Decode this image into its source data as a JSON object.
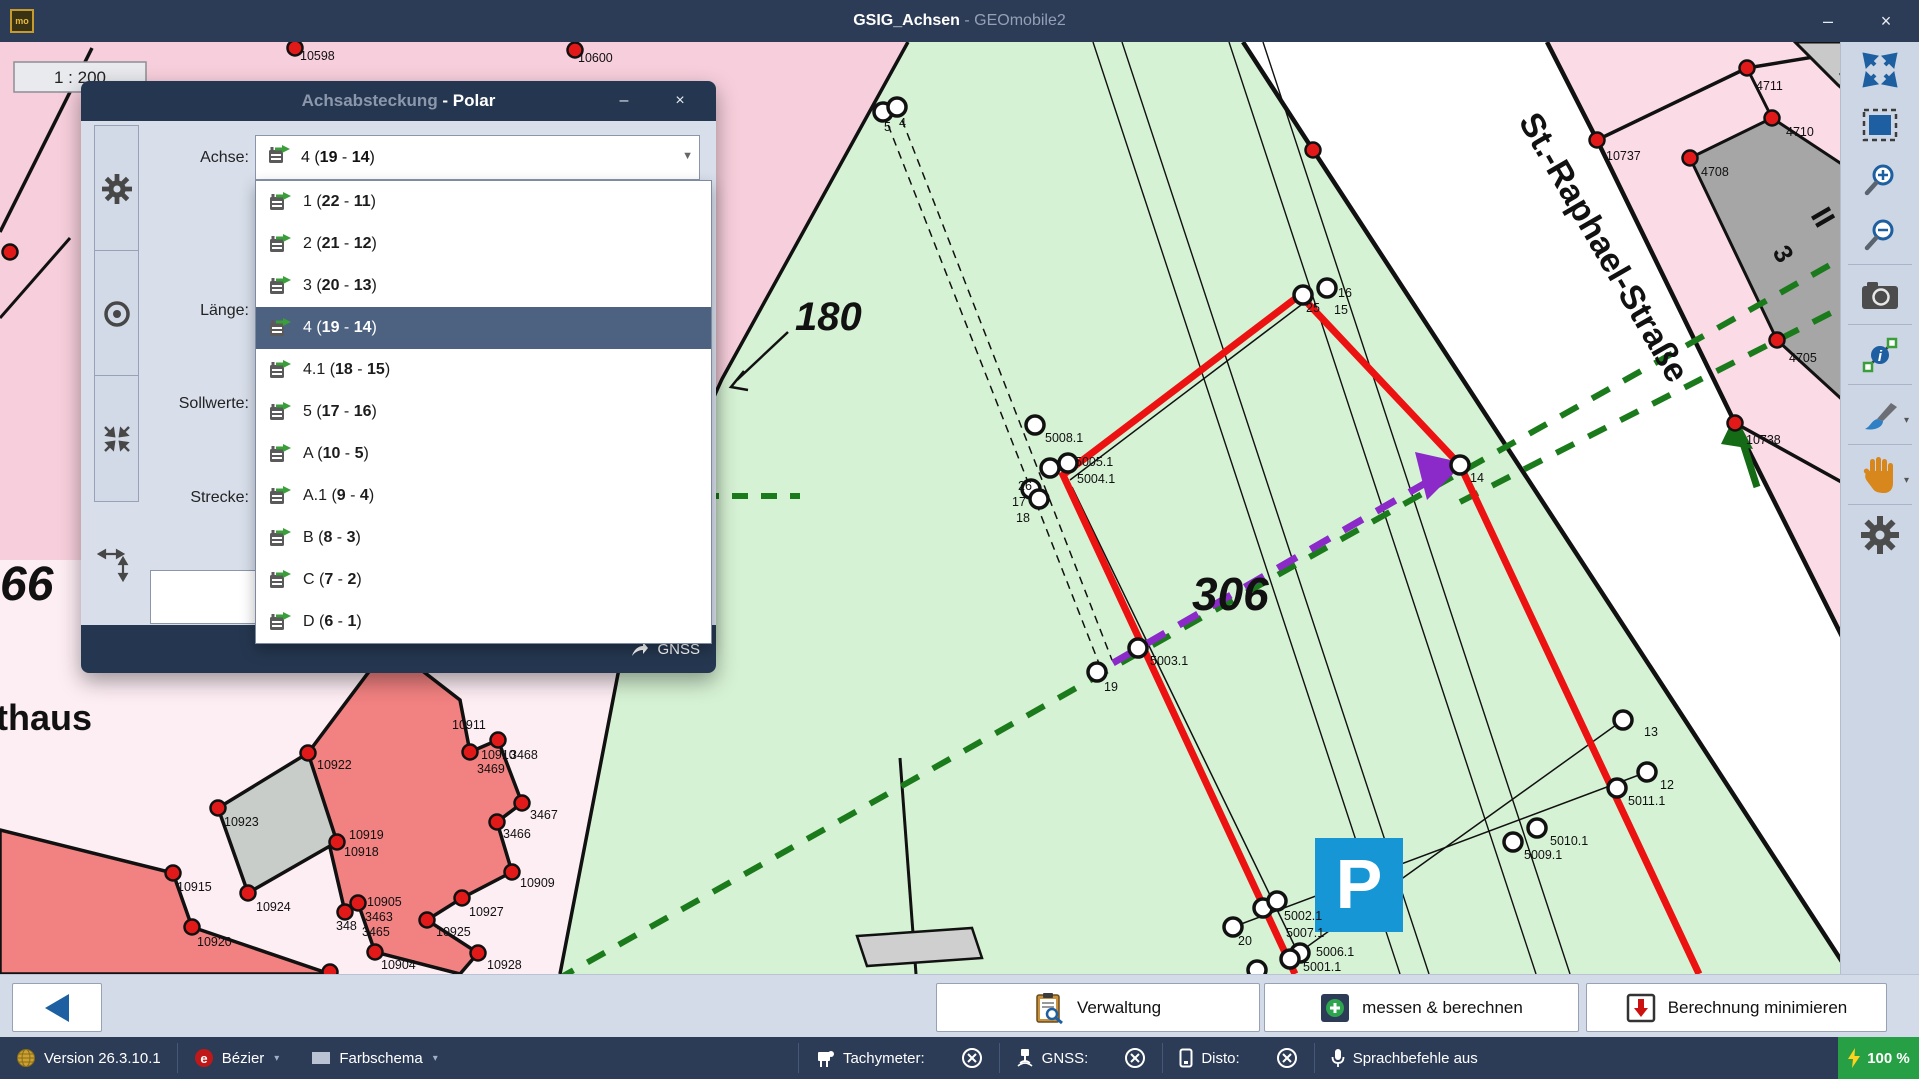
{
  "window": {
    "project": "GSIG_Achsen",
    "app": " - GEOmobile2",
    "badge": "mo",
    "minimize": "–",
    "close": "×"
  },
  "dialog": {
    "title_main": "Achsabsteckung",
    "title_mode": " - Polar",
    "minimize": "–",
    "close": "×",
    "labels": {
      "achse": "Achse:",
      "laenge": "Länge:",
      "sollwerte": "Sollwerte:",
      "strecke": "Strecke:"
    },
    "combo": {
      "name": "4",
      "from": "19",
      "to": "14"
    },
    "gnss_label": "GNSS",
    "dropdown": {
      "selected_index": 3,
      "items": [
        {
          "name": "1",
          "from": "22",
          "to": "11"
        },
        {
          "name": "2",
          "from": "21",
          "to": "12"
        },
        {
          "name": "3",
          "from": "20",
          "to": "13"
        },
        {
          "name": "4",
          "from": "19",
          "to": "14"
        },
        {
          "name": "4.1",
          "from": "18",
          "to": "15"
        },
        {
          "name": "5",
          "from": "17",
          "to": "16"
        },
        {
          "name": "A",
          "from": "10",
          "to": "5"
        },
        {
          "name": "A.1",
          "from": "9",
          "to": "4"
        },
        {
          "name": "B",
          "from": "8",
          "to": "3"
        },
        {
          "name": "C",
          "from": "7",
          "to": "2"
        },
        {
          "name": "D",
          "from": "6",
          "to": "1"
        }
      ]
    }
  },
  "bottom_bar": {
    "verwaltung": "Verwaltung",
    "messen": "messen & berechnen",
    "berechnung": "Berechnung minimieren"
  },
  "status_bar": {
    "version": "Version 26.3.10.1",
    "bezier": "Bézier",
    "farbschema": "Farbschema",
    "tachymeter": "Tachymeter:",
    "gnss": "GNSS:",
    "disto": "Disto:",
    "sprachbefehle": "Sprachbefehle aus",
    "battery": "100 %"
  },
  "map": {
    "scale": "1 : 200",
    "street_label": "St.-Raphael-Straße",
    "parking_label": "P",
    "big": {
      "n180": "180",
      "n306": "306",
      "n66": "66",
      "thaus": "thaus"
    },
    "building_marks": {
      "i": "I",
      "ii": "II",
      "three": "3"
    },
    "colors": {
      "green": "#d6f2d4",
      "pink": "#f7cfdc",
      "pink_light": "#fdeef4",
      "pink_right": "#fadbe6",
      "red_line": "#ec1212",
      "purple": "#8b2ac8",
      "green_dash": "#1b7a1b",
      "salmon": "#f28181",
      "gray_building": "#a6a6a6",
      "parking_blue": "#1796d5"
    },
    "white_points": [
      [
        883,
        112
      ],
      [
        897,
        107
      ],
      [
        1035,
        425
      ],
      [
        1050,
        468
      ],
      [
        1068,
        463
      ],
      [
        1031,
        489
      ],
      [
        1039,
        499
      ],
      [
        1303,
        295
      ],
      [
        1327,
        288
      ],
      [
        1460,
        465
      ],
      [
        1097,
        672
      ],
      [
        1138,
        648
      ],
      [
        1233,
        927
      ],
      [
        1263,
        908
      ],
      [
        1277,
        901
      ],
      [
        1300,
        953
      ],
      [
        1290,
        959
      ],
      [
        1257,
        970
      ],
      [
        1513,
        842
      ],
      [
        1537,
        828
      ],
      [
        1617,
        788
      ],
      [
        1647,
        772
      ],
      [
        1623,
        720
      ]
    ],
    "red_points": [
      [
        1597,
        140
      ],
      [
        1735,
        423
      ],
      [
        1747,
        68
      ],
      [
        1772,
        118
      ],
      [
        1690,
        158
      ],
      [
        1777,
        340
      ],
      [
        1313,
        150
      ],
      [
        308,
        753
      ],
      [
        218,
        808
      ],
      [
        248,
        893
      ],
      [
        337,
        842
      ],
      [
        173,
        873
      ],
      [
        192,
        927
      ],
      [
        470,
        752
      ],
      [
        498,
        740
      ],
      [
        522,
        803
      ],
      [
        497,
        822
      ],
      [
        512,
        872
      ],
      [
        462,
        898
      ],
      [
        427,
        920
      ],
      [
        478,
        953
      ],
      [
        375,
        952
      ],
      [
        358,
        903
      ],
      [
        345,
        912
      ],
      [
        389,
        645
      ],
      [
        295,
        48
      ],
      [
        575,
        50
      ],
      [
        10,
        252
      ],
      [
        330,
        972
      ]
    ],
    "labels": [
      {
        "t": "10598",
        "x": 300,
        "y": 60
      },
      {
        "t": "10600",
        "x": 578,
        "y": 62
      },
      {
        "t": "5",
        "x": 884,
        "y": 131
      },
      {
        "t": "4",
        "x": 899,
        "y": 127
      },
      {
        "t": "5008.1",
        "x": 1045,
        "y": 442
      },
      {
        "t": "5005.1",
        "x": 1075,
        "y": 466
      },
      {
        "t": "5004.1",
        "x": 1077,
        "y": 483
      },
      {
        "t": "26",
        "x": 1018,
        "y": 490
      },
      {
        "t": "17",
        "x": 1012,
        "y": 506
      },
      {
        "t": "18",
        "x": 1016,
        "y": 522
      },
      {
        "t": "16",
        "x": 1338,
        "y": 297
      },
      {
        "t": "25",
        "x": 1306,
        "y": 312
      },
      {
        "t": "15",
        "x": 1334,
        "y": 314
      },
      {
        "t": "14",
        "x": 1470,
        "y": 482
      },
      {
        "t": "19",
        "x": 1104,
        "y": 691
      },
      {
        "t": "5003.1",
        "x": 1150,
        "y": 665
      },
      {
        "t": "20",
        "x": 1238,
        "y": 945
      },
      {
        "t": "5002.1",
        "x": 1284,
        "y": 920
      },
      {
        "t": "5007.1",
        "x": 1286,
        "y": 937
      },
      {
        "t": "5006.1",
        "x": 1316,
        "y": 956
      },
      {
        "t": "5001.1",
        "x": 1303,
        "y": 971
      },
      {
        "t": "5009.1",
        "x": 1524,
        "y": 859
      },
      {
        "t": "5010.1",
        "x": 1550,
        "y": 845
      },
      {
        "t": "5011.1",
        "x": 1628,
        "y": 805
      },
      {
        "t": "12",
        "x": 1660,
        "y": 789
      },
      {
        "t": "13",
        "x": 1644,
        "y": 736
      },
      {
        "t": "4711",
        "x": 1756,
        "y": 90
      },
      {
        "t": "4710",
        "x": 1786,
        "y": 136
      },
      {
        "t": "4708",
        "x": 1701,
        "y": 176
      },
      {
        "t": "4705",
        "x": 1789,
        "y": 362
      },
      {
        "t": "10737",
        "x": 1606,
        "y": 160
      },
      {
        "t": "10738",
        "x": 1746,
        "y": 444
      },
      {
        "t": "10922",
        "x": 317,
        "y": 769
      },
      {
        "t": "10923",
        "x": 224,
        "y": 826
      },
      {
        "t": "10924",
        "x": 256,
        "y": 911
      },
      {
        "t": "10919",
        "x": 349,
        "y": 839
      },
      {
        "t": "10918",
        "x": 344,
        "y": 856
      },
      {
        "t": "10915",
        "x": 177,
        "y": 891
      },
      {
        "t": "10920",
        "x": 197,
        "y": 946
      },
      {
        "t": "10911",
        "x": 452,
        "y": 729
      },
      {
        "t": "10910",
        "x": 481,
        "y": 759
      },
      {
        "t": "3468",
        "x": 510,
        "y": 759
      },
      {
        "t": "3469",
        "x": 477,
        "y": 773
      },
      {
        "t": "3467",
        "x": 530,
        "y": 819
      },
      {
        "t": "3466",
        "x": 503,
        "y": 838
      },
      {
        "t": "10909",
        "x": 520,
        "y": 887
      },
      {
        "t": "10927",
        "x": 469,
        "y": 916
      },
      {
        "t": "10925",
        "x": 436,
        "y": 936
      },
      {
        "t": "10928",
        "x": 487,
        "y": 969
      },
      {
        "t": "10904",
        "x": 381,
        "y": 969
      },
      {
        "t": "10905",
        "x": 367,
        "y": 906
      },
      {
        "t": "3463",
        "x": 365,
        "y": 921
      },
      {
        "t": "3465",
        "x": 362,
        "y": 936
      },
      {
        "t": "348",
        "x": 336,
        "y": 930
      }
    ]
  }
}
